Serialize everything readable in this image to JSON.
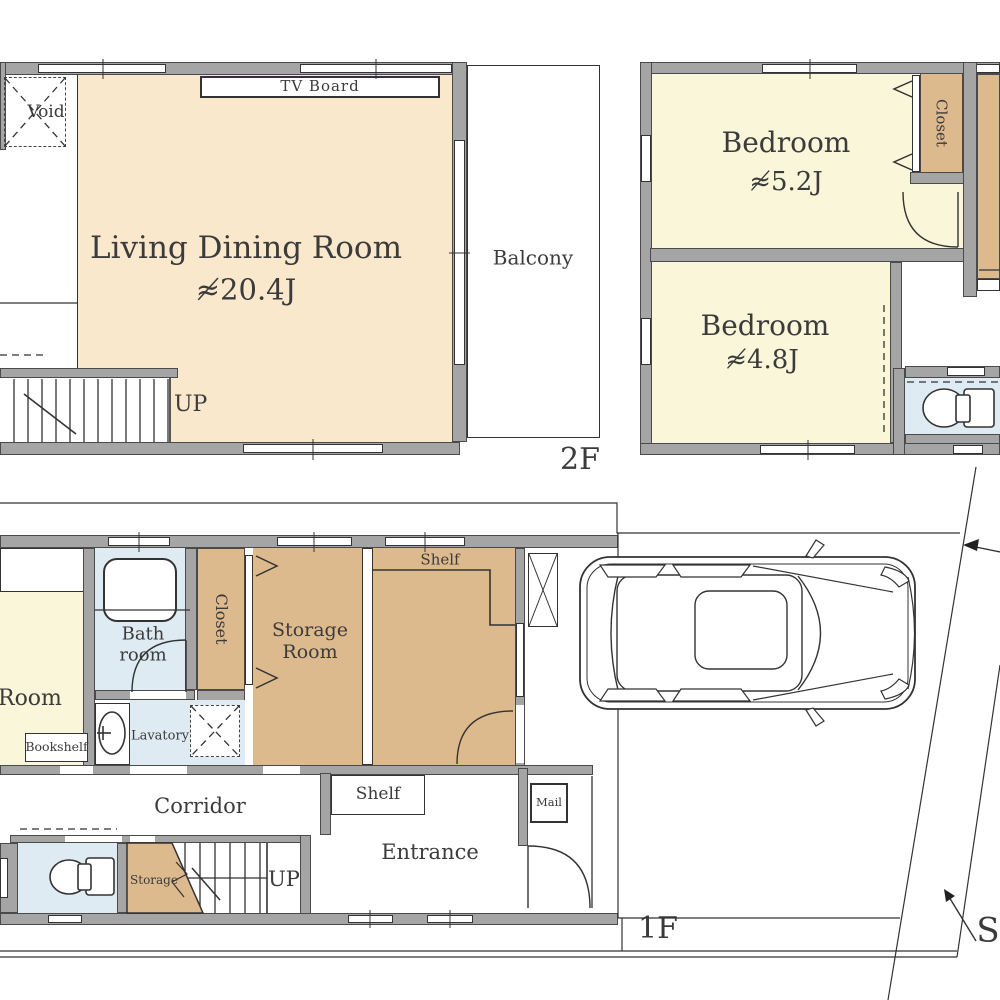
{
  "title": "House floor plan",
  "colors": {
    "wall": "#a5a5a5",
    "cream": "#fae8cd",
    "yellow": "#f9f6d9",
    "tan": "#ddb98e",
    "blue": "#deebf3",
    "line": "#333333"
  },
  "floor2": {
    "label": "2F",
    "living": {
      "name": "Living Dining Room",
      "area": "≉20.4J"
    },
    "tv_board": "TV Board",
    "void": "Void",
    "stairs_up": "UP",
    "balcony": "Balcony",
    "bedroom_a": {
      "name": "Bedroom",
      "area": "≉5.2J"
    },
    "bedroom_b": {
      "name": "Bedroom",
      "area": "≉4.8J"
    },
    "closet": "Closet"
  },
  "floor1": {
    "label": "1F",
    "room": "Room",
    "bookshelf": "Bookshelf",
    "bath_line1": "Bath",
    "bath_line2": "room",
    "closet": "Closet",
    "storage_line1": "Storage",
    "storage_line2": "Room",
    "shelf_storage": "Shelf",
    "lavatory": "Lavatory",
    "corridor": "Corridor",
    "storage_stairs": "Storage",
    "stairs_up": "UP",
    "shelf_entrance": "Shelf",
    "entrance": "Entrance",
    "mail": "Mail"
  },
  "site": {
    "direction_marker": "S"
  }
}
